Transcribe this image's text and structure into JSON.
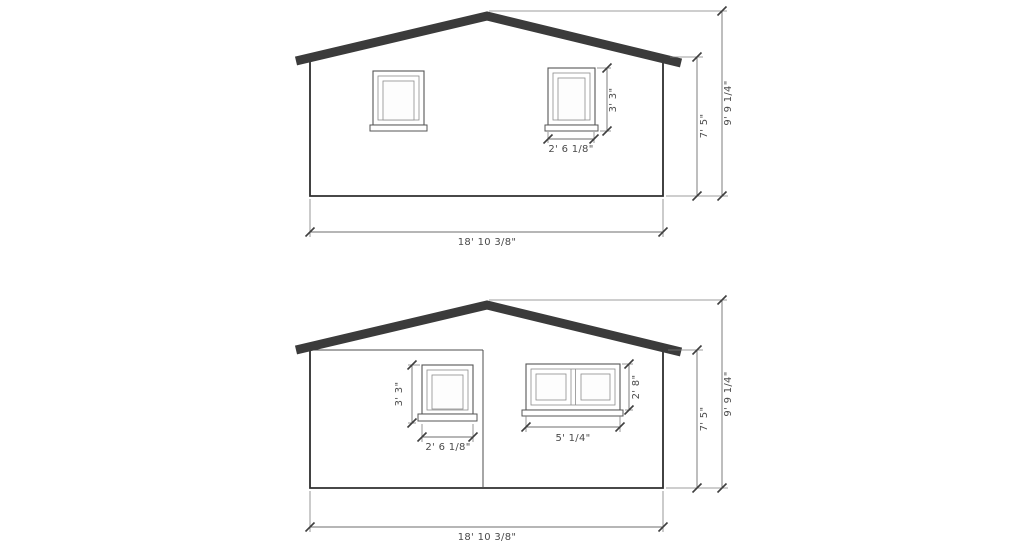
{
  "document": {
    "type": "architectural elevation drawing",
    "background": "#ffffff",
    "colors": {
      "roof": "#3b3b3b",
      "wall_line": "#2e2e2e",
      "window_line": "#565656",
      "dimension_line": "#6e6e6e",
      "dimension_text": "#4a4a4a"
    }
  },
  "elevation_top": {
    "window_right_height": "3' 3\"",
    "window_right_width": "2' 6 1/8\"",
    "wall_height": "7' 5\"",
    "overall_height": "9' 9 1/4\"",
    "overall_width": "18' 10 3/8\""
  },
  "elevation_bottom": {
    "single_window_height": "3' 3\"",
    "single_window_width": "2' 6 1/8\"",
    "double_window_height": "2' 8\"",
    "double_window_width": "5' 1/4\"",
    "wall_height": "7' 5\"",
    "overall_height": "9' 9 1/4\"",
    "overall_width": "18' 10 3/8\""
  }
}
